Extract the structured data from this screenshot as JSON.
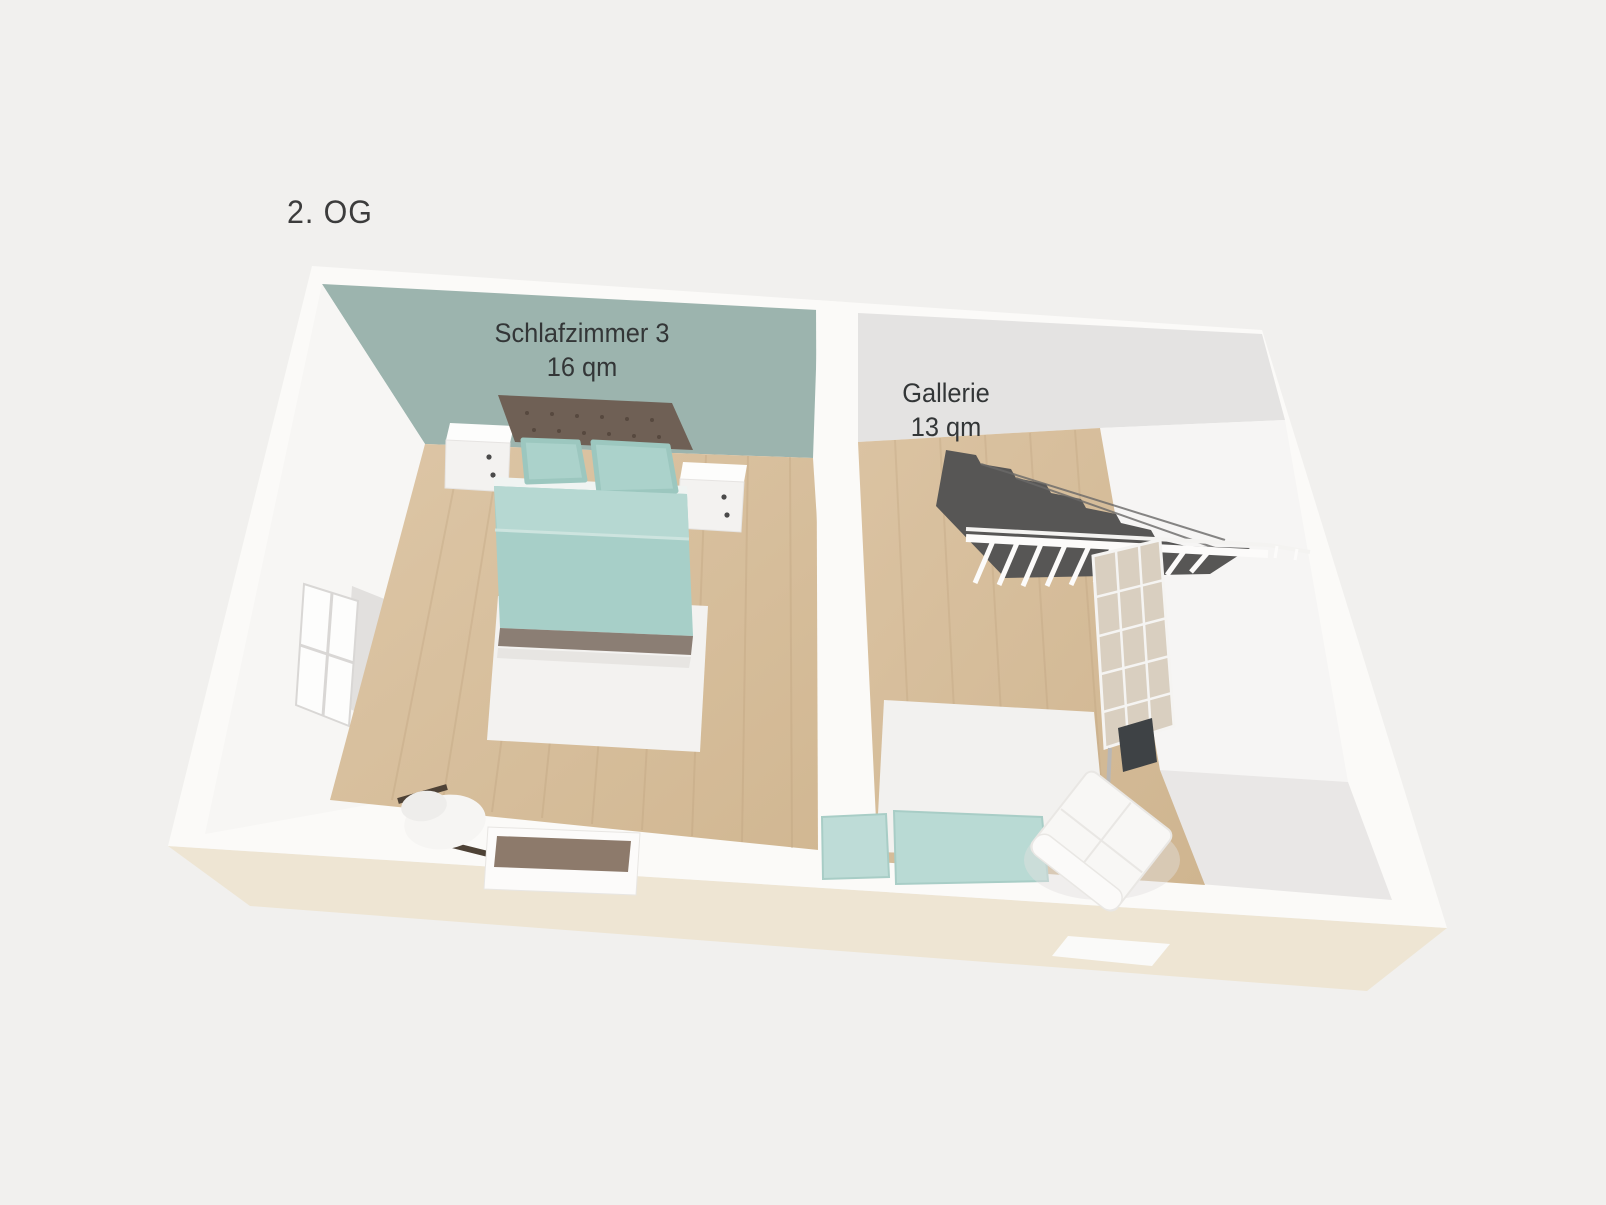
{
  "title": {
    "floor_label": "2. OG"
  },
  "rooms": [
    {
      "id": "schlafzimmer-3",
      "name": "Schlafzimmer 3",
      "area": "16 qm",
      "wall_color": "#9cb4ae",
      "floor_material": "wood"
    },
    {
      "id": "gallerie",
      "name": "Gallerie",
      "area": "13 qm",
      "wall_color": "#e4e3e2",
      "floor_material": "wood"
    }
  ],
  "furniture": {
    "schlafzimmer-3": [
      "double-bed",
      "tufted-headboard",
      "nightstand-left",
      "nightstand-right",
      "pillows",
      "white-rug",
      "chair",
      "dresser",
      "window"
    ],
    "gallerie": [
      "staircase-down",
      "stair-railing",
      "glass-partition",
      "white-rug",
      "sofa-teal",
      "armchair-white"
    ]
  },
  "colors": {
    "background": "#f1f0ee",
    "wall_top": "#fbfaf8",
    "wall_front_face": "#efe7d5",
    "bedroom_wall": "#9cb4ae",
    "gallery_wall": "#e4e3e2",
    "floor_wood": "#d8bf9e",
    "stairs_dark": "#575655",
    "bedding_teal": "#a7cfc8",
    "headboard_brown": "#6f6055",
    "rug_white": "#f2f1ef",
    "label_text": "#393b3b"
  }
}
